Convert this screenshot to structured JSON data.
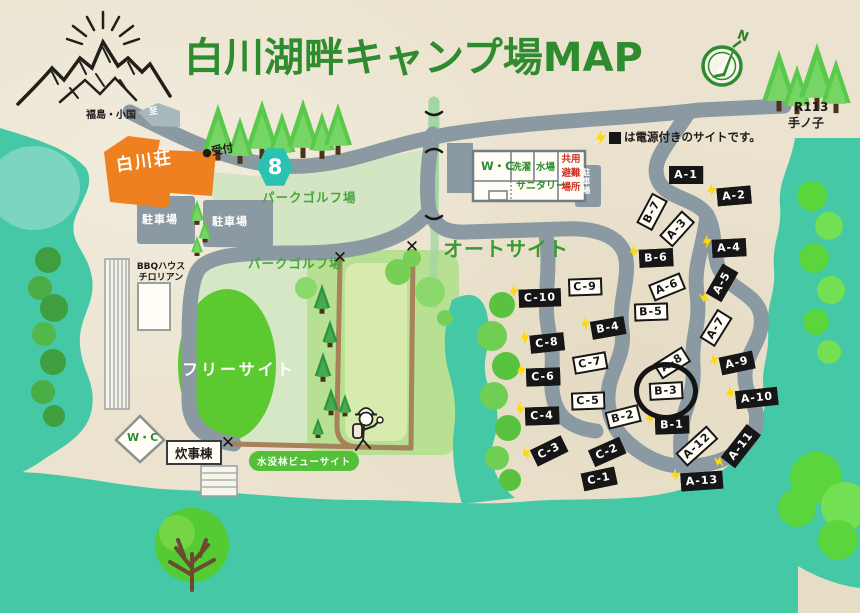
{
  "title": "白川湖畔キャンプ場MAP",
  "compass_n": "N",
  "route": {
    "badge": "8",
    "r113": "R113",
    "tenoko": "手ノ子"
  },
  "top_left": {
    "dest": "福島・小国",
    "to": "至"
  },
  "legend": {
    "suffix": "は電源付きのサイトです。"
  },
  "areas": {
    "auto_site": "オートサイト",
    "free_site": "フリーサイト",
    "park_golf_upper": "パークゴルフ場",
    "park_golf_lower": "パークゴルフ場",
    "flooded_forest_view": "水没林ビューサイト"
  },
  "facilities": {
    "shirakawa_so": "白川荘",
    "reception": "●受付",
    "parking1": "駐車場",
    "parking2": "駐車場",
    "parking3": "駐車場",
    "wc_main": "W・C",
    "laundry": "洗濯",
    "water": "水場",
    "sanitary": "サニタリー",
    "shared_evac": [
      "共用",
      "避難",
      "場所"
    ],
    "bbq_line1": "BBQハウス",
    "bbq_line2": "チロリアン",
    "wc_south": "W・C",
    "cooking": "炊事棟"
  },
  "marks": {
    "x": "✕"
  },
  "sites": [
    {
      "label": "A-1",
      "x": 686,
      "y": 175,
      "rot": 0,
      "black": true,
      "bolt": false
    },
    {
      "label": "A-2",
      "x": 734,
      "y": 196,
      "rot": -5,
      "black": true,
      "bolt": true
    },
    {
      "label": "B-7",
      "x": 652,
      "y": 212,
      "rot": -62,
      "black": false,
      "bolt": false
    },
    {
      "label": "A-3",
      "x": 677,
      "y": 229,
      "rot": -48,
      "black": false,
      "bolt": false
    },
    {
      "label": "A-4",
      "x": 729,
      "y": 248,
      "rot": -3,
      "black": true,
      "bolt": true
    },
    {
      "label": "B-6",
      "x": 656,
      "y": 258,
      "rot": -3,
      "black": true,
      "bolt": true
    },
    {
      "label": "A-6",
      "x": 667,
      "y": 287,
      "rot": -22,
      "black": false,
      "bolt": false
    },
    {
      "label": "A-5",
      "x": 722,
      "y": 283,
      "rot": -60,
      "black": true,
      "bolt": true
    },
    {
      "label": "B-5",
      "x": 651,
      "y": 312,
      "rot": -2,
      "black": false,
      "bolt": false
    },
    {
      "label": "A-7",
      "x": 716,
      "y": 328,
      "rot": -58,
      "black": false,
      "bolt": false
    },
    {
      "label": "C-9",
      "x": 585,
      "y": 287,
      "rot": -2,
      "black": false,
      "bolt": false
    },
    {
      "label": "C-10",
      "x": 540,
      "y": 298,
      "rot": -2,
      "black": true,
      "bolt": true
    },
    {
      "label": "B-4",
      "x": 608,
      "y": 328,
      "rot": -10,
      "black": true,
      "bolt": true
    },
    {
      "label": "C-8",
      "x": 547,
      "y": 343,
      "rot": -6,
      "black": true,
      "bolt": true
    },
    {
      "label": "C-7",
      "x": 590,
      "y": 363,
      "rot": -10,
      "black": false,
      "bolt": false
    },
    {
      "label": "A-8",
      "x": 672,
      "y": 363,
      "rot": -32,
      "black": false,
      "bolt": false
    },
    {
      "label": "A-9",
      "x": 737,
      "y": 363,
      "rot": -12,
      "black": true,
      "bolt": true
    },
    {
      "label": "C-6",
      "x": 543,
      "y": 377,
      "rot": -2,
      "black": true,
      "bolt": true
    },
    {
      "label": "B-3",
      "x": 666,
      "y": 391,
      "rot": -3,
      "black": false,
      "bolt": false,
      "circled": true
    },
    {
      "label": "A-10",
      "x": 757,
      "y": 398,
      "rot": -6,
      "black": true,
      "bolt": true
    },
    {
      "label": "C-5",
      "x": 588,
      "y": 401,
      "rot": -2,
      "black": false,
      "bolt": false
    },
    {
      "label": "C-4",
      "x": 542,
      "y": 416,
      "rot": -2,
      "black": true,
      "bolt": true
    },
    {
      "label": "B-2",
      "x": 623,
      "y": 417,
      "rot": -14,
      "black": false,
      "bolt": false
    },
    {
      "label": "B-1",
      "x": 672,
      "y": 425,
      "rot": -2,
      "black": true,
      "bolt": true
    },
    {
      "label": "A-12",
      "x": 697,
      "y": 446,
      "rot": -42,
      "black": false,
      "bolt": false
    },
    {
      "label": "A-11",
      "x": 741,
      "y": 446,
      "rot": -52,
      "black": true,
      "bolt": true
    },
    {
      "label": "C-3",
      "x": 549,
      "y": 451,
      "rot": -26,
      "black": true,
      "bolt": true
    },
    {
      "label": "C-2",
      "x": 607,
      "y": 452,
      "rot": -24,
      "black": true,
      "bolt": false
    },
    {
      "label": "C-1",
      "x": 599,
      "y": 479,
      "rot": -12,
      "black": true,
      "bolt": false
    },
    {
      "label": "A-13",
      "x": 702,
      "y": 481,
      "rot": -4,
      "black": true,
      "bolt": true
    }
  ]
}
